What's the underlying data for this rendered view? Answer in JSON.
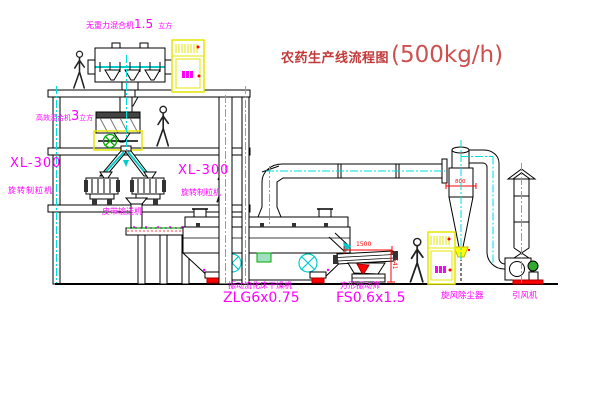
{
  "title": {
    "text": "农药生产线流程图",
    "capacity": "(500kg/h)"
  },
  "equipment": {
    "gravity_mixer": {
      "name": "无重力混合机",
      "size": "1.5",
      "unit": "立方"
    },
    "high_eff_mixer": {
      "name": "高效混合机",
      "size": "3",
      "unit": "立方"
    },
    "granulator_left": {
      "model": "XL-300",
      "name": "旋转制粒机"
    },
    "granulator_right": {
      "model": "XL-300",
      "name": "旋转制粒机"
    },
    "belt_conveyor": {
      "name": "皮带输送机"
    },
    "fluid_bed_dryer": {
      "name": "振动流化床干燥机",
      "model": "ZLG6x0.75"
    },
    "vibrating_sieve": {
      "name": "方形振动筛",
      "model": "FS0.6x1.5"
    },
    "cyclone": {
      "name": "旋风除尘器"
    },
    "fan": {
      "name": "引风机"
    }
  },
  "dimensions": {
    "sieve_length": "1500",
    "sieve_height": "541",
    "cyclone_width": "800"
  },
  "colors": {
    "line": "#000000",
    "centerline": "#00dddd",
    "label": "#ff00ff",
    "title": "#c23a3a",
    "dimension": "#ff0000",
    "cabinet": "#e6e600",
    "accent_green": "#00aa00"
  }
}
